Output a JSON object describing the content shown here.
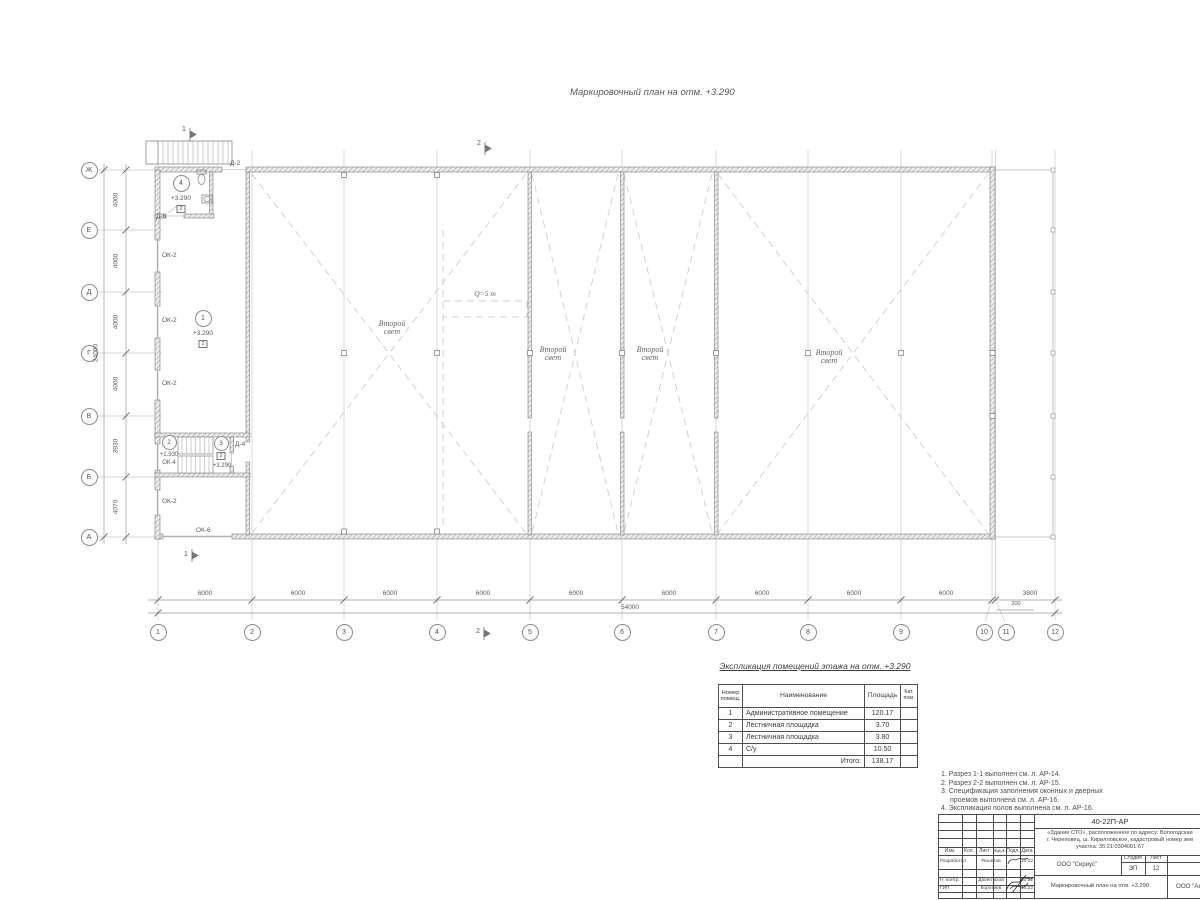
{
  "page": {
    "plan_title": "Маркировочный план на отм. +3.290"
  },
  "palette": {
    "wall_hatch": "#9c9c9c",
    "thin_line": "#c6c6c6",
    "dim_line": "#999999",
    "text": "#555555",
    "dash": "#d2d2d2",
    "titleblock_line": "#4a4a4a"
  },
  "grid": {
    "col_labels": [
      "1",
      "2",
      "3",
      "4",
      "5",
      "6",
      "7",
      "8",
      "9",
      "10",
      "11",
      "12"
    ],
    "row_labels": [
      "Ж",
      "Е",
      "Д",
      "Г",
      "В",
      "Б",
      "А"
    ],
    "col_dims": [
      "6000",
      "6000",
      "6000",
      "6000",
      "6000",
      "6000",
      "6000",
      "6000",
      "6000",
      "200",
      "3800"
    ],
    "row_dims": [
      "4000",
      "4000",
      "4000",
      "4000",
      "3930",
      "4070"
    ],
    "total_width_dim": "54000",
    "total_height_dim": "24000"
  },
  "plan": {
    "second_light_label": "Второй свет",
    "crane_label": "Q=5 т",
    "section_marks": [
      "1",
      "2"
    ],
    "windows": [
      "ОК-2",
      "ОК-2",
      "ОК-2",
      "ОК-2",
      "ОК-6"
    ],
    "doors": [
      "Д-2",
      "Д-6",
      "Д-4"
    ],
    "rooms": [
      {
        "num": "1",
        "elev": "+3.290",
        "cat": "2"
      },
      {
        "num": "2",
        "elev": "+1.930",
        "window": "ОК-4"
      },
      {
        "num": "3",
        "elev": "+3.290",
        "cat": "2"
      },
      {
        "num": "4",
        "elev": "+3.290",
        "cat": "2"
      }
    ]
  },
  "explication": {
    "title": "Экспликация помещений этажа на отм. +3.290",
    "headers": {
      "num": "Номер помещ.",
      "name": "Наименование",
      "area": "Площадь",
      "cat": "Кат. пом."
    },
    "rows": [
      {
        "num": "1",
        "name": "Административное помещение",
        "area": "120.17",
        "cat": ""
      },
      {
        "num": "2",
        "name": "Лестничная площадка",
        "area": "3.70",
        "cat": ""
      },
      {
        "num": "3",
        "name": "Лестничная площадка",
        "area": "3.80",
        "cat": ""
      },
      {
        "num": "4",
        "name": "С/у",
        "area": "10.50",
        "cat": ""
      }
    ],
    "total_label": "Итого:",
    "total_value": "138.17"
  },
  "notes": [
    "1. Разрез 1-1 выполнен см. л. АР-14.",
    "2. Разрез 2-2 выполнен см. л. АР-15.",
    "3. Спецификация заполнения оконных и дверных",
    "проемов выполнена см. л. АР-16.",
    "4. Экспликация полов выполнена см. л. АР-16."
  ],
  "titleblock": {
    "doc_number": "40-22П-АР",
    "project_line1": "«Здание СТО», расположенное по адресу: Вологодская",
    "project_line2": "г. Череповец, ш. Кирилловское, кадастровый номер зем",
    "project_line3": "участка: 35:21:0304001:67",
    "header_cells": [
      "Изм.",
      "Кол.",
      "Лист",
      "№док.",
      "Подл.",
      "Дата"
    ],
    "sign_rows": [
      {
        "role": "Разработал",
        "name": "Решетов",
        "date": "10.22"
      },
      {
        "role": "Н. контр.",
        "name": "Двоеглазов",
        "date": "10.22"
      },
      {
        "role": "ГИП",
        "name": "Коротаев",
        "date": "10.22"
      }
    ],
    "org": "ООО \"Сириус\"",
    "stage_label": "Стадия",
    "sheet_label": "Лист",
    "stage": "ЭП",
    "sheet": "12",
    "drawing_title": "Маркировочный план на отм. +3.290",
    "org2": "ООО \"Ал"
  }
}
